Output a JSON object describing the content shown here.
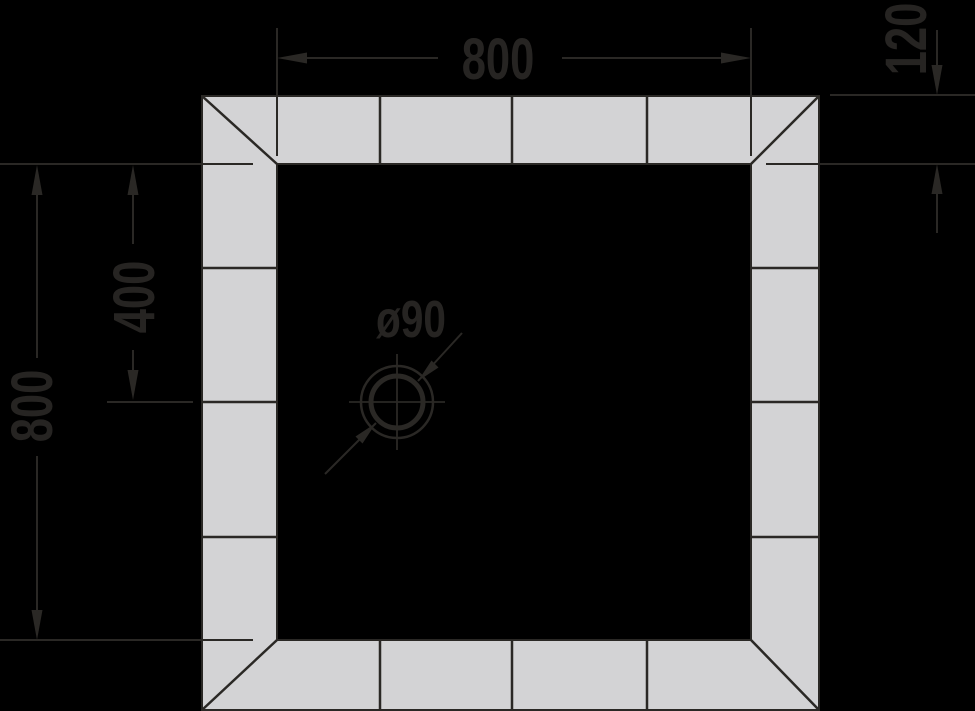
{
  "colors": {
    "background": "#000000",
    "frame_fill": "#d3d3d5",
    "line": "#2a2825",
    "text": "#262422"
  },
  "dimensions": {
    "overall_width": {
      "label": "800",
      "value": 800
    },
    "overall_height": {
      "label": "800",
      "value": 800
    },
    "drain_center_from_top": {
      "label": "400",
      "value": 400
    },
    "border_width": {
      "label": "120",
      "value": 120
    },
    "drain_diameter": {
      "label": "ø90",
      "value": 90
    }
  }
}
